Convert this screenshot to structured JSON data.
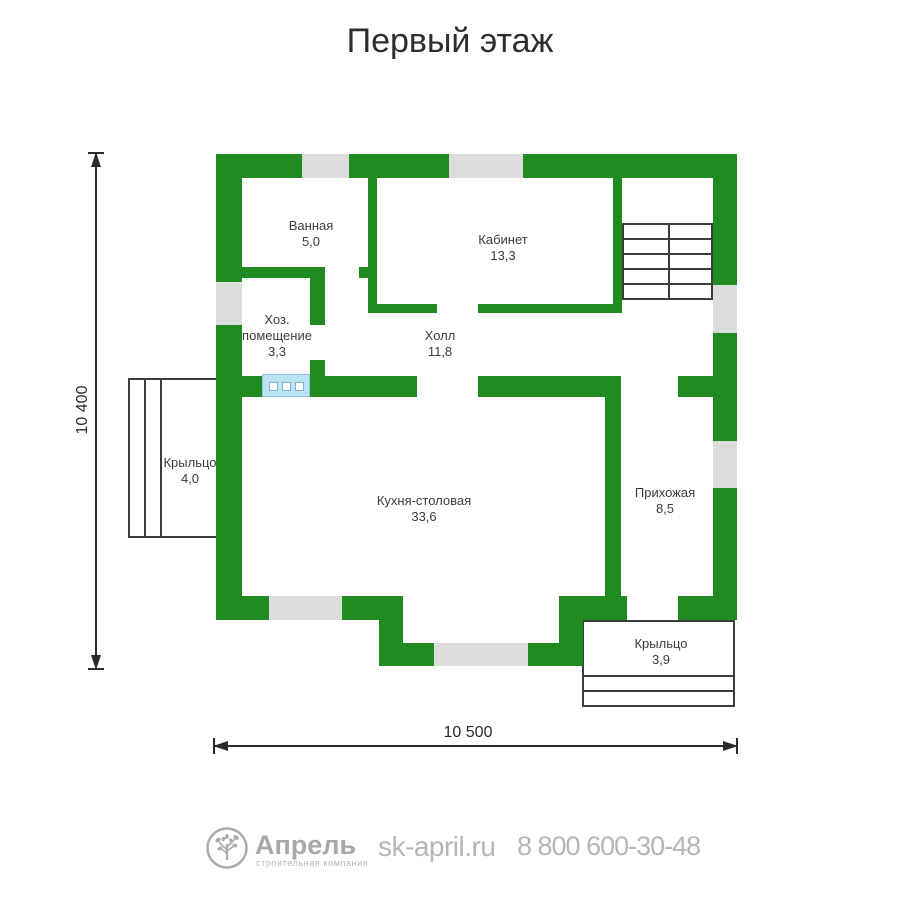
{
  "title": "Первый этаж",
  "dimensions": {
    "vertical": "10 400",
    "horizontal": "10 500"
  },
  "rooms": {
    "bathroom": {
      "name": "Ванная",
      "area": "5,0"
    },
    "office": {
      "name": "Кабинет",
      "area": "13,3"
    },
    "utility": {
      "line1": "Хоз.",
      "line2": "помещение",
      "area": "3,3"
    },
    "hall": {
      "name": "Холл",
      "area": "11,8"
    },
    "kitchen": {
      "name": "Кухня-столовая",
      "area": "33,6"
    },
    "entry": {
      "name": "Прихожая",
      "area": "8,5"
    },
    "porch_left": {
      "name": "Крыльцо",
      "area": "4,0"
    },
    "porch_bottom": {
      "name": "Крыльцо",
      "area": "3,9"
    }
  },
  "footer": {
    "brand": "Апрель",
    "tagline": "строительная компания",
    "website": "sk-april.ru",
    "phone": "8 800 600-30-48"
  },
  "colors": {
    "wall_green": "#1f8b20",
    "window_gray": "#dcdcdc",
    "window_blue": "#bce3f5",
    "outline_dark": "#3d3d3d",
    "footer_gray": "#b2b2b2"
  }
}
